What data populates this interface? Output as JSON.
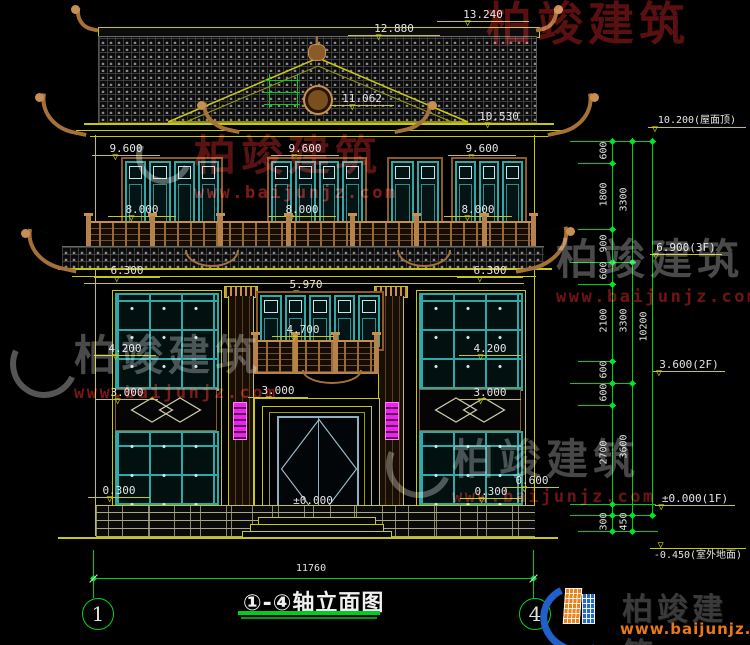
{
  "icons": {
    "level_marker": "▽"
  },
  "watermark": {
    "brand": "柏竣建筑",
    "url": "www.baijunjz.com"
  },
  "logo": {
    "brand": "柏竣建筑",
    "url": "www.baijunjz.com"
  },
  "footer": {
    "title": "①-④轴立面图",
    "axis_left": "1",
    "axis_right": "4",
    "total_width": "11760"
  },
  "elevations": {
    "r13240": "13.240",
    "r12880": "12.880",
    "r11062": "11.062",
    "r10530": "10.530",
    "f9600": "9.600",
    "f8000": "8.000",
    "f6300": "6.300",
    "f5970": "5.970",
    "f4700": "4.700",
    "f4200": "4.200",
    "f3000": "3.000",
    "f2700": "2.700",
    "f0600": "0.600",
    "f0300": "0.300",
    "f0000": "±0.000"
  },
  "right_chain": {
    "roof_label": "10.200(屋面顶)",
    "f3_label": "6.900(3F)",
    "f2_label": "3.600(2F)",
    "f1_label": "±0.000(1F)",
    "ground_label": "-0.450(室外地面)",
    "seg_600": "600",
    "seg_1800": "1800",
    "seg_900": "900",
    "seg_2100": "2100",
    "seg_2700": "2700",
    "seg_300": "300",
    "seg_450": "450",
    "sub_3300": "3300",
    "sub_3600": "3600",
    "total_10200": "10200"
  }
}
